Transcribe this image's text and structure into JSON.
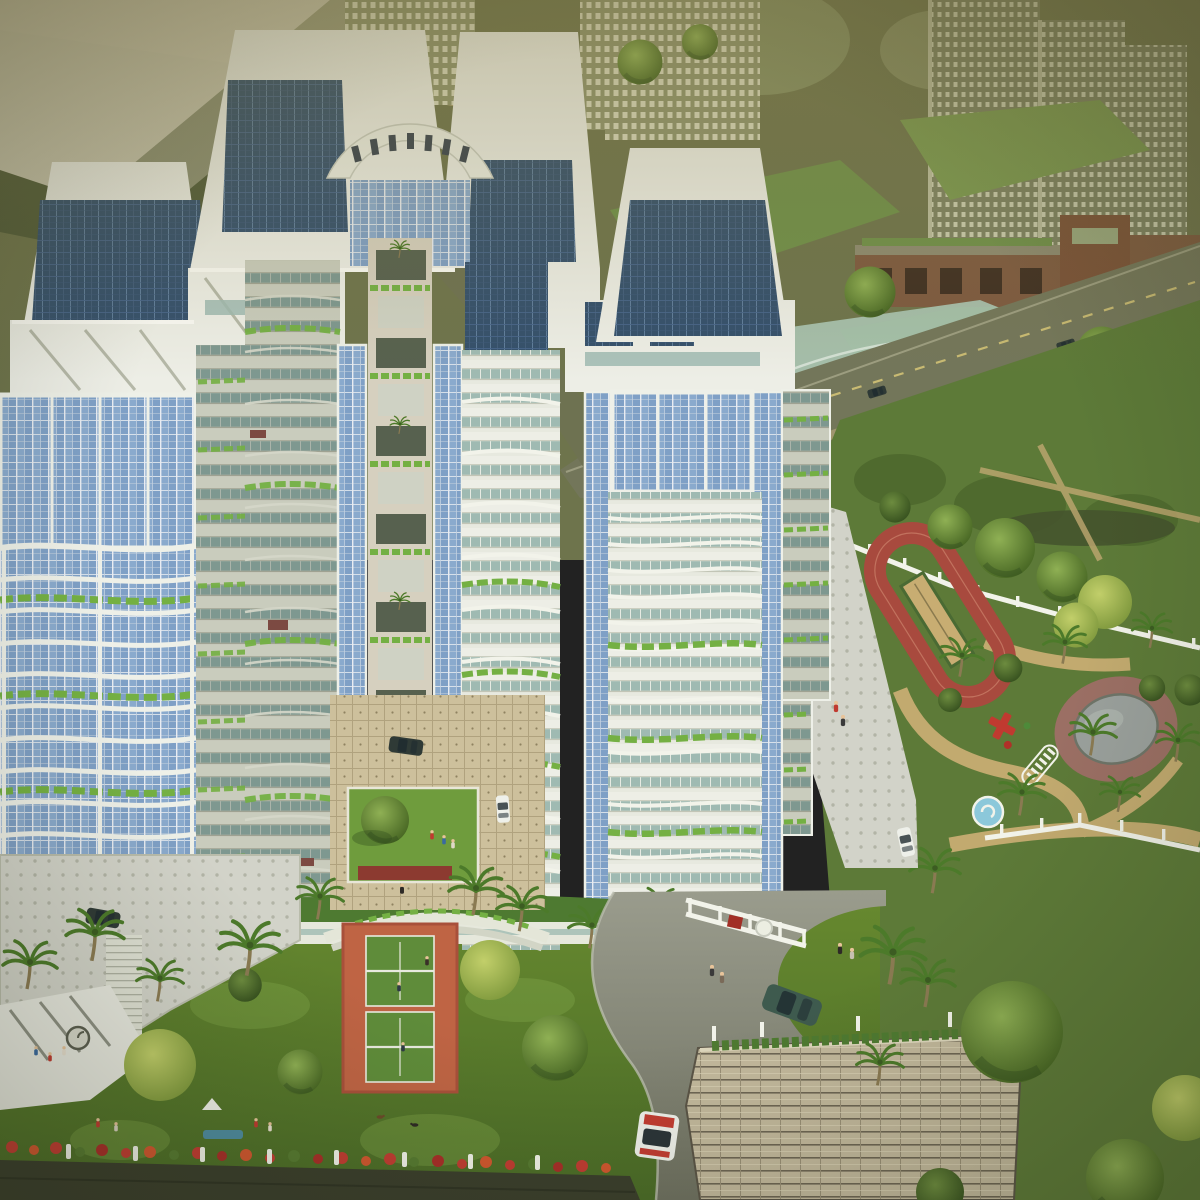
{
  "description": "Aerial architectural rendering of a residential high-rise complex: four white towers with blue glass curtain walls, curved planter balconies and a curved colonnade bridge between the rear tower crowns; central landscaped courtyard with lawn and parked cars; tennis court and podium gardens with palms, picnicking people and dogs in front; children's playground with red jogging track, sand pit, grey pond, fountain and red play equipment behind a white fence at right; curved grey entrance driveway with cars, white gate railing and a large tiled gatehouse roof at bottom right; sepia-toned township with distant towers, glass pavilion, brick gate buildings and an avenue with cars in the background.",
  "palette": {
    "bg_olive": "#6e744c",
    "bg_dark": "#4f5a38",
    "path_tan": "#bfae7e",
    "road_olive": "#73765a",
    "lane_yellow": "#d8c878",
    "park_green": "#5d7a38",
    "park_dark": "#4c672c",
    "grass_bottom": "#5c7c33",
    "grass_light": "#7fa449",
    "track_red": "#a84a3e",
    "sand_tan": "#c8ad72",
    "pond_grey": "#9aa09c",
    "pond_paving": "#9b6f64",
    "fountain_blue": "#8cc8da",
    "plaza_grey": "#d2d3c9",
    "fence_white": "#f2f3ea",
    "tower_white": "#edeee6",
    "tower_shade": "#c9ccbd",
    "glass_blue": "#7fa0c6",
    "glass_dark": "#34506c",
    "teal_band": "#9fbab2",
    "planter_green": "#74b043",
    "hedge_green": "#4e7a31",
    "courtyard_tile": "#cdc09c",
    "lawn_green": "#6f9c3d",
    "tennis_orange": "#bf6444",
    "tennis_court": "#5f8c3a",
    "roof_tile": "#c2b89c",
    "road_grey": "#8f9186",
    "wall_dark": "#3a3e2c",
    "flower_red": "#c23c32",
    "tree_green": "#567a31",
    "tree_dark": "#3f5c28",
    "tree_yellow": "#a8bc55",
    "palm_green": "#4c7a2a",
    "trunk_brown": "#8a7a52",
    "car_dark": "#2f3a36",
    "car_green": "#3e5a4e",
    "car_white": "#eef0ea",
    "car_red": "#b04034",
    "people_red": "#c03a30",
    "people_blue": "#3a6aa0"
  },
  "scene": {
    "complex": {
      "towers": 4,
      "features": [
        "trapezoid crowns with dark glass penthouses",
        "curved colonnade bridge with 7 openings",
        "sky terraces with palms",
        "blue glass curtain walls",
        "wavy balcony slabs",
        "green planter bands"
      ]
    },
    "amenities": [
      "tennis-court",
      "central-lawn-courtyard",
      "jogging-track",
      "sand-pit",
      "pond",
      "fountain",
      "play-equipment",
      "amphitheater-steps",
      "podium-deck",
      "gatehouse"
    ],
    "vehicles": [
      {
        "name": "courtyard-dark-car",
        "color": "#2f3a36"
      },
      {
        "name": "courtyard-white-car",
        "color": "#eef0ea"
      },
      {
        "name": "podium-dark-car",
        "color": "#2f3a36"
      },
      {
        "name": "plaza-white-car",
        "color": "#eef0ea"
      },
      {
        "name": "driveway-green-sedan",
        "color": "#3e5a4e"
      },
      {
        "name": "driveway-white-red-car",
        "color": "#eef0ea"
      },
      {
        "name": "avenue-red-car",
        "color": "#b04034"
      },
      {
        "name": "avenue-dark-cars",
        "color": "#2f3a36"
      }
    ],
    "figures": [
      "picnic-groups",
      "children-playing",
      "two-dogs",
      "tennis-players",
      "pedestrians"
    ]
  }
}
